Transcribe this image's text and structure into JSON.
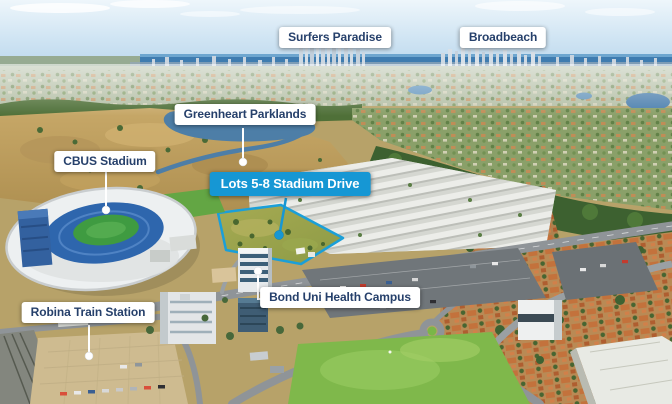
{
  "scene": {
    "type": "annotated-aerial-photograph"
  },
  "colors": {
    "accent_blue": "#1697d4",
    "site_outline_blue": "#1b9fd8",
    "label_background": "#ffffff",
    "label_text": "#26406b"
  },
  "annotations": [
    {
      "id": "surfers-paradise",
      "text": "Surfers Paradise",
      "style": "white-box"
    },
    {
      "id": "broadbeach",
      "text": "Broadbeach",
      "style": "white-box"
    },
    {
      "id": "greenheart-parklands",
      "text": "Greenheart Parklands",
      "style": "white-box-with-pointer"
    },
    {
      "id": "cbus-stadium",
      "text": "CBUS Stadium",
      "style": "white-box-with-pointer"
    },
    {
      "id": "lots-5-8-stadium-drive",
      "text": "Lots 5-8 Stadium Drive",
      "style": "blue-highlight-box-with-pointer"
    },
    {
      "id": "bond-uni-health-campus",
      "text": "Bond Uni Health Campus",
      "style": "white-box-with-pointer"
    },
    {
      "id": "robina-train-station",
      "text": "Robina Train Station",
      "style": "white-box-with-pointer"
    }
  ]
}
